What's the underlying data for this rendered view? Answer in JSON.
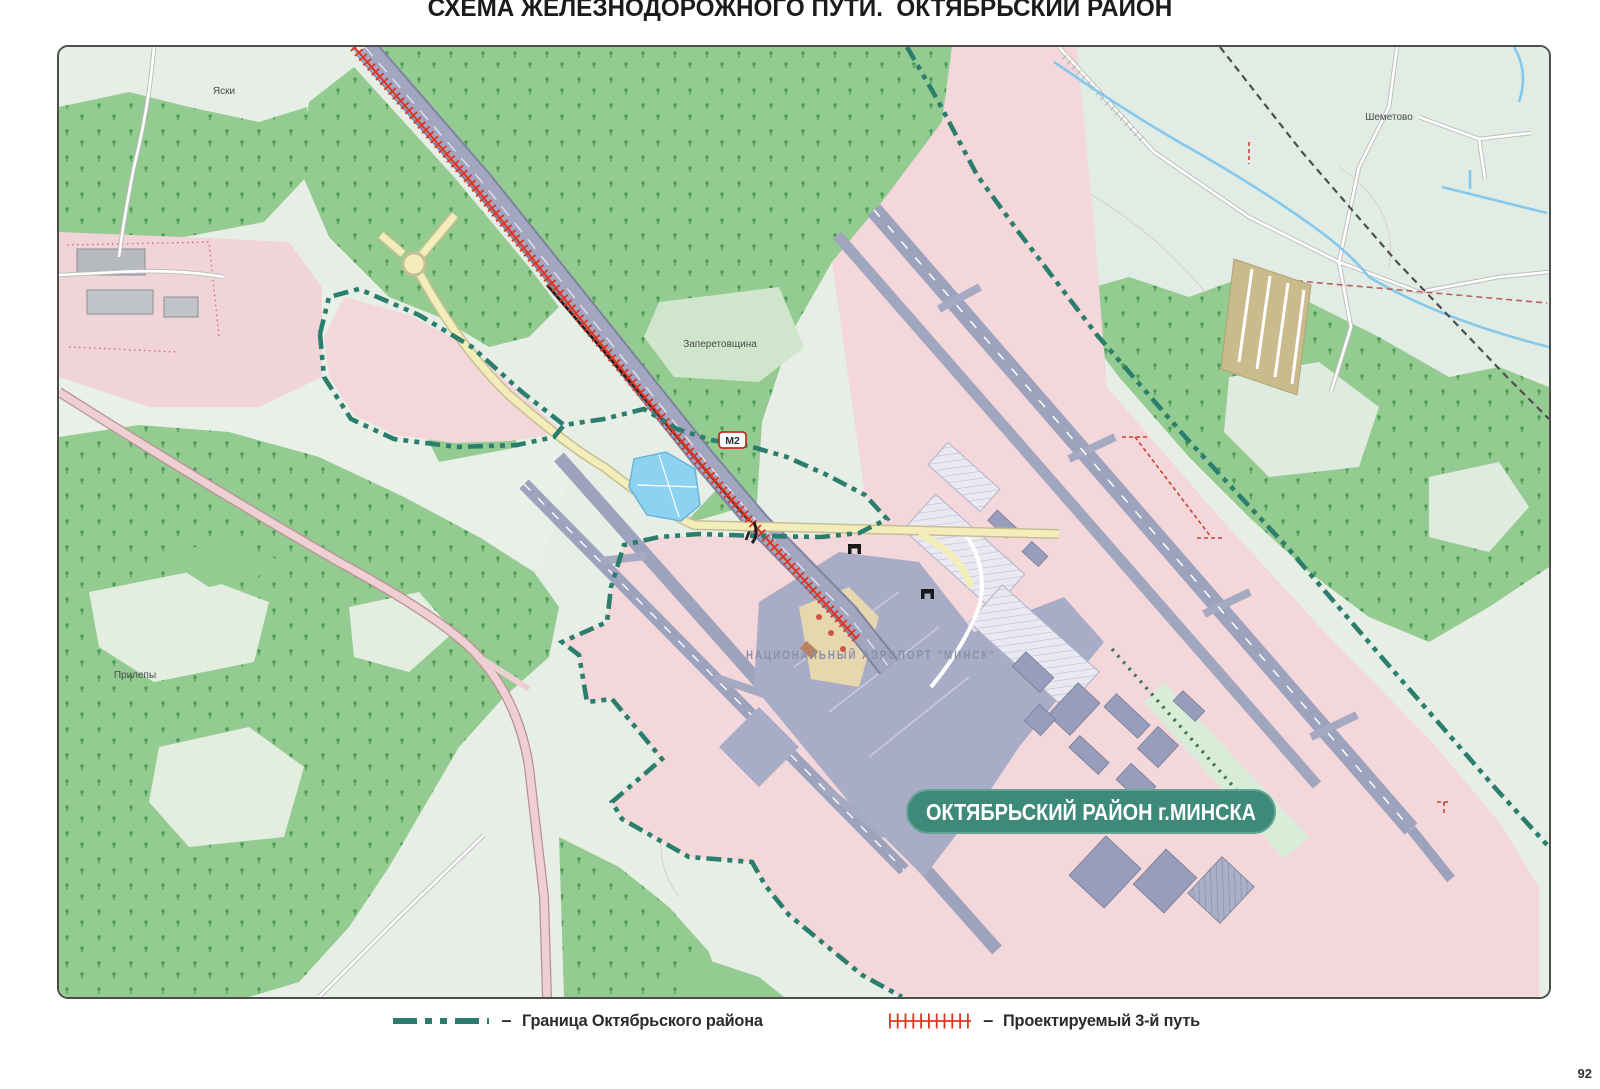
{
  "title": "СХЕМА ЖЕЛЕЗНОДОРОЖНОГО ПУТИ.  ОКТЯБРЬСКИЙ РАЙОН",
  "page_number": "92",
  "map": {
    "district_label": "ОКТЯБРЬСКИЙ РАЙОН г.МИНСКА",
    "airport_label": "НАЦИОНАЛЬНЫЙ АЭРОПОРТ \"МИНСК\"",
    "road_badge": "М2",
    "villages": [
      "Яски",
      "Шеметово",
      "Заперетовщина",
      "Прилепы"
    ]
  },
  "legend": {
    "dash": "–",
    "items": [
      {
        "symbol": "district-border",
        "label": "Граница Октябрьского района"
      },
      {
        "symbol": "projected-track",
        "label": "Проектируемый 3-й путь"
      }
    ]
  },
  "colors": {
    "district_boundary": "#2b7e6d",
    "projected_track": "#e03422",
    "district_box": "#3e8a7a",
    "airport_zone_pink": "#f3d7da",
    "forest_green": "#94cb90",
    "runway_gray": "#9da2bd",
    "pond_blue": "#8ed2f2",
    "road_yellow": "#f3edba"
  }
}
